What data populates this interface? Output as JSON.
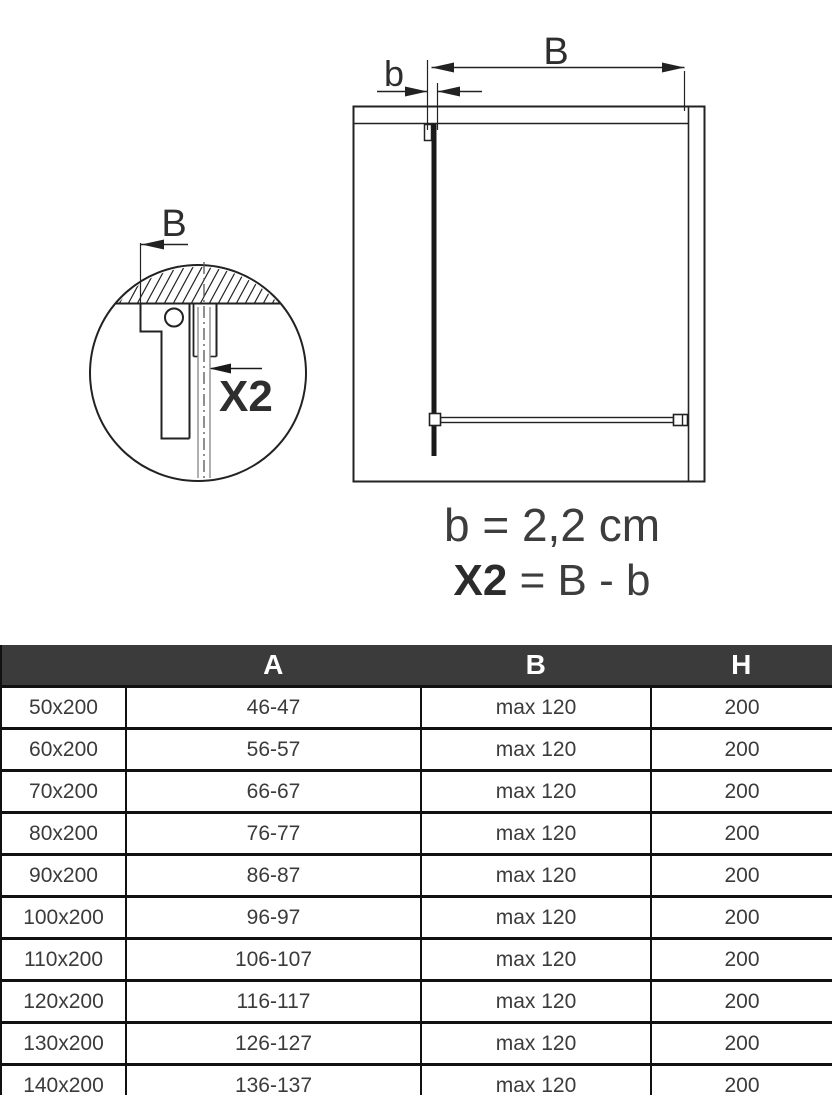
{
  "diagram": {
    "main_view": {
      "dim_B_label": "B",
      "dim_b_label": "b"
    },
    "detail_view": {
      "dim_B_label": "B",
      "x2_label": "X2"
    },
    "formulas": {
      "b_formula": "b = 2,2 cm",
      "x2_formula_bold": "X2",
      "x2_formula_rest": " = B - b"
    }
  },
  "table": {
    "headers": {
      "size": "",
      "a": "A",
      "b": "B",
      "h": "H"
    },
    "rows": [
      {
        "size": "50x200",
        "a": "46-47",
        "b": "max 120",
        "h": "200"
      },
      {
        "size": "60x200",
        "a": "56-57",
        "b": "max 120",
        "h": "200"
      },
      {
        "size": "70x200",
        "a": "66-67",
        "b": "max 120",
        "h": "200"
      },
      {
        "size": "80x200",
        "a": "76-77",
        "b": "max 120",
        "h": "200"
      },
      {
        "size": "90x200",
        "a": "86-87",
        "b": "max 120",
        "h": "200"
      },
      {
        "size": "100x200",
        "a": "96-97",
        "b": "max 120",
        "h": "200"
      },
      {
        "size": "110x200",
        "a": "106-107",
        "b": "max 120",
        "h": "200"
      },
      {
        "size": "120x200",
        "a": "116-117",
        "b": "max 120",
        "h": "200"
      },
      {
        "size": "130x200",
        "a": "126-127",
        "b": "max 120",
        "h": "200"
      },
      {
        "size": "140x200",
        "a": "136-137",
        "b": "max 120",
        "h": "200"
      }
    ]
  },
  "colors": {
    "header_bg": "#3b3b3b",
    "header_text": "#ffffff",
    "line": "#222222",
    "text": "#3d3d3d",
    "border": "#111111"
  }
}
